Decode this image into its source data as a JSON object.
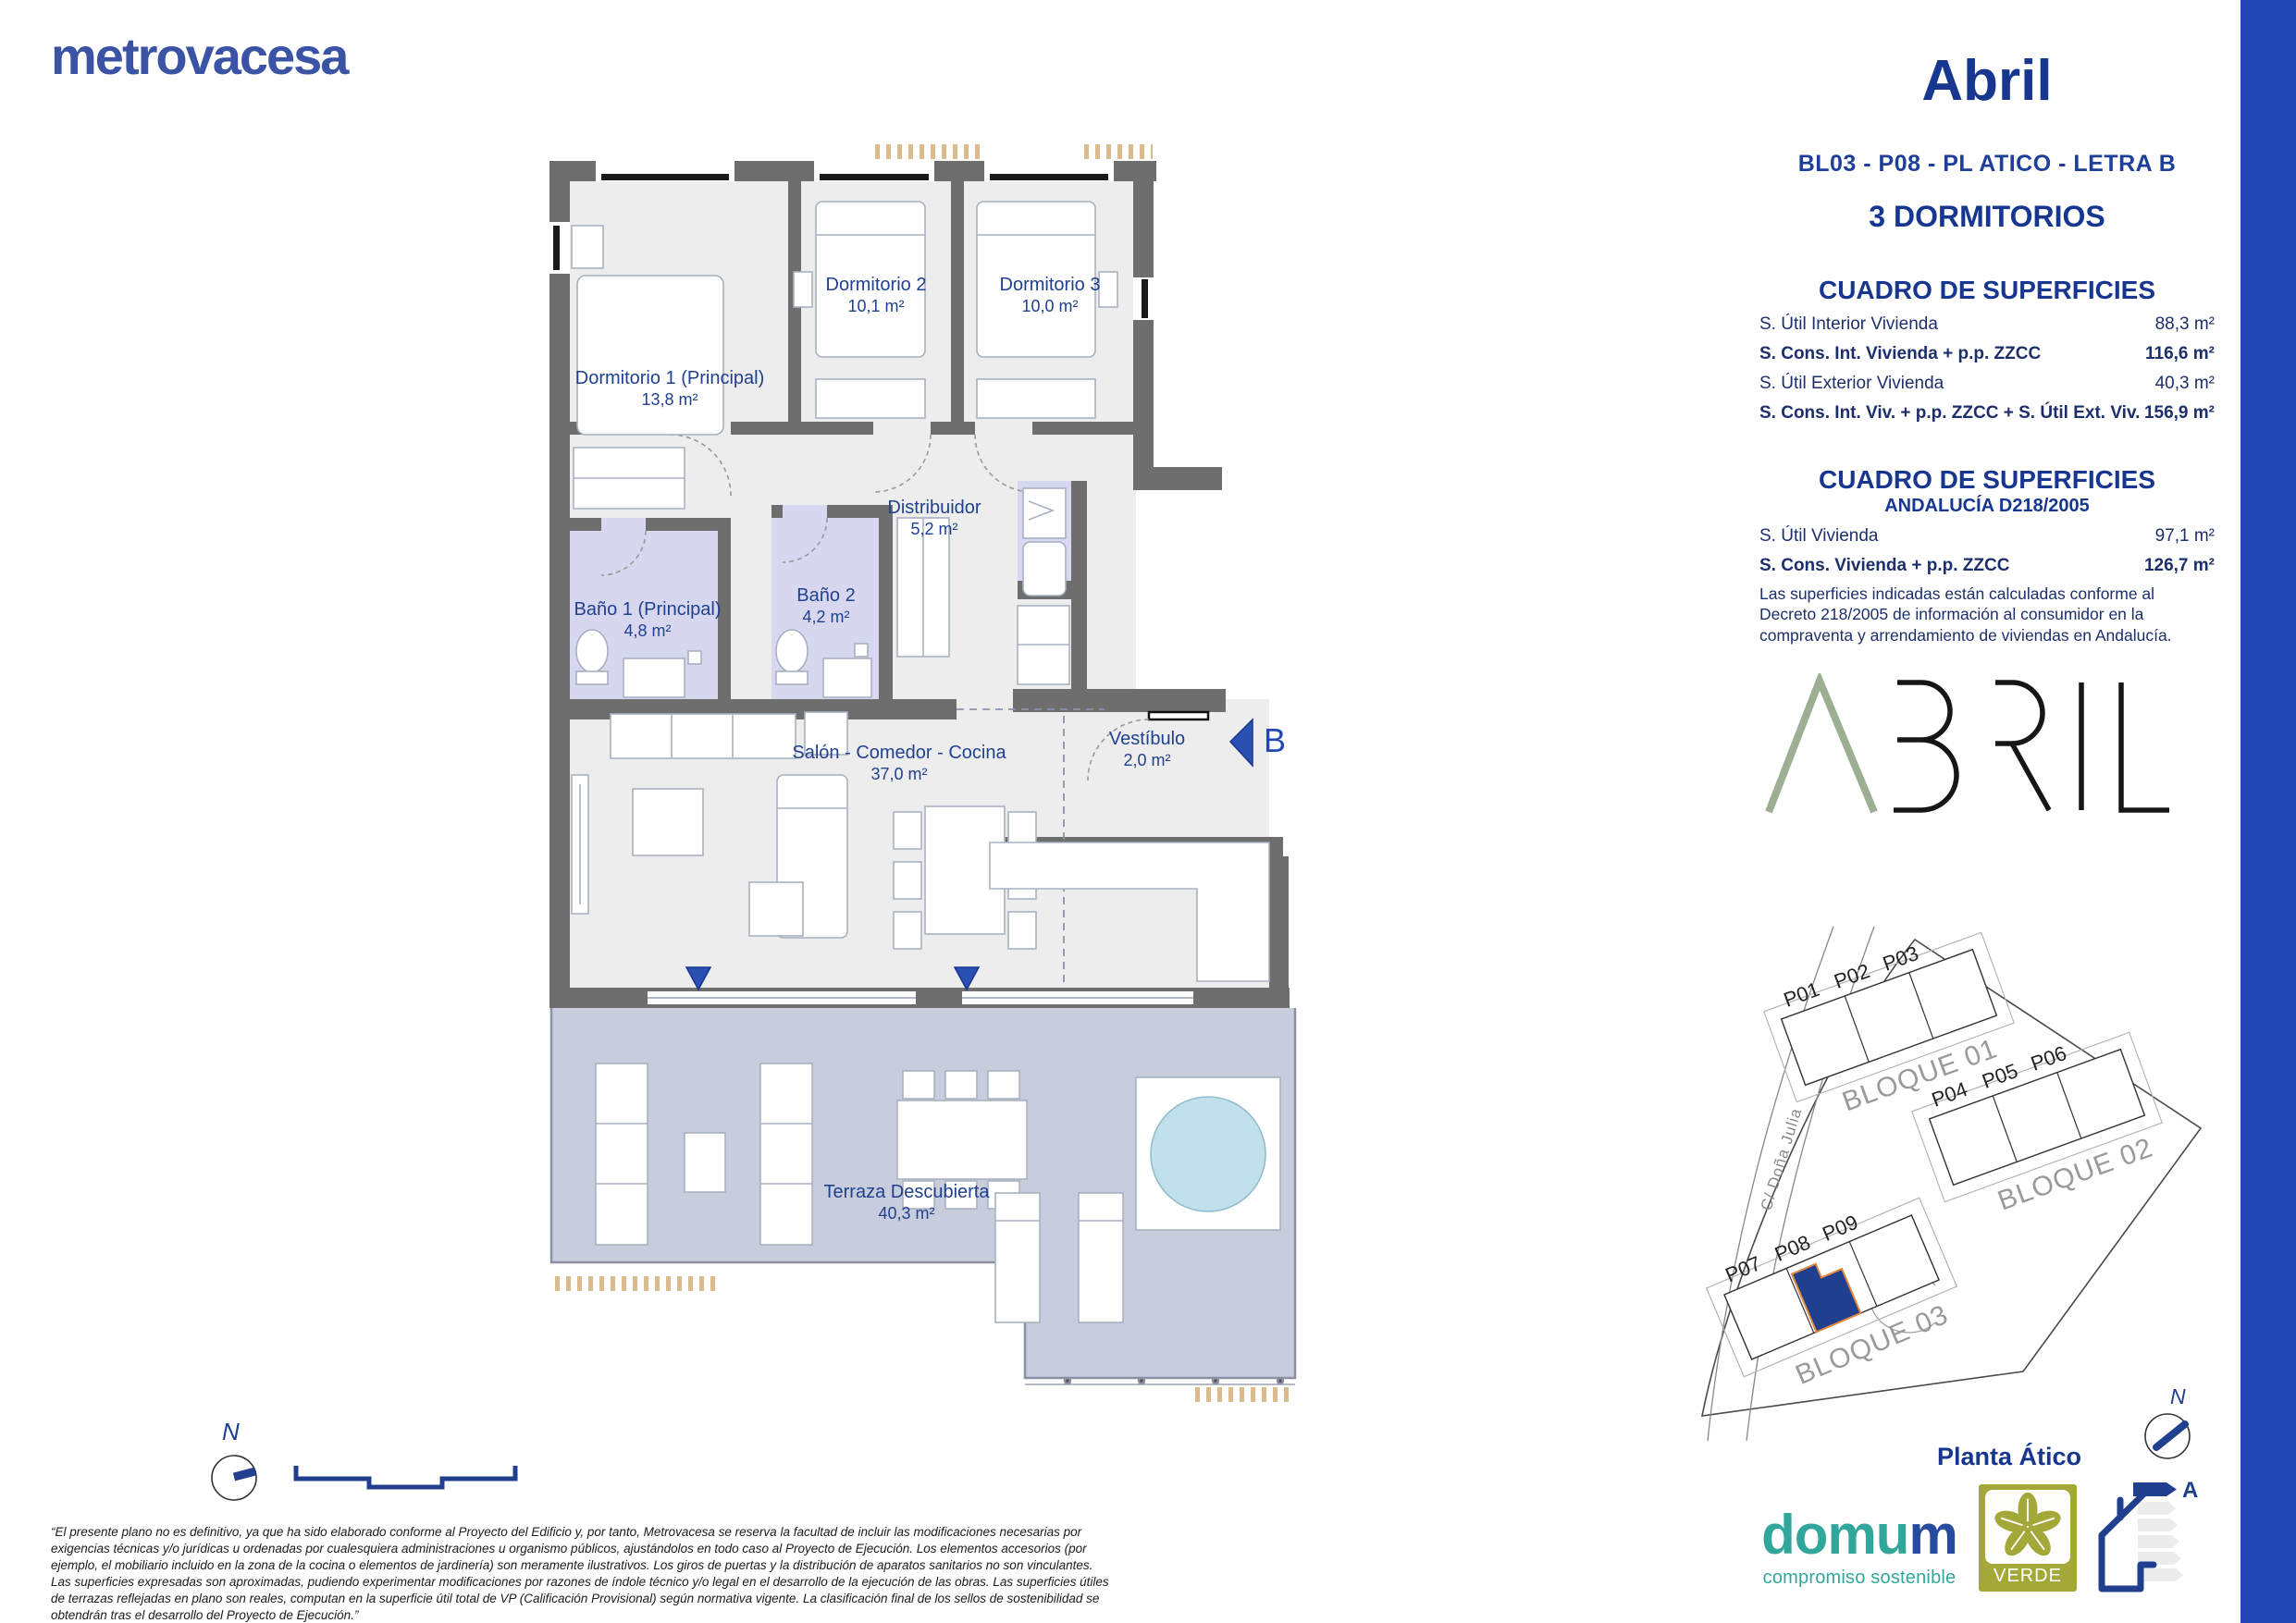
{
  "page": {
    "brand": "metrovacesa",
    "title": "Abril",
    "subtitle": "BL03 - P08 - PL ATICO - LETRA B",
    "bedrooms": "3 DORMITORIOS"
  },
  "tables": {
    "main": {
      "title": "CUADRO DE SUPERFICIES",
      "rows": [
        {
          "label": "S. Útil Interior Vivienda",
          "value": "88,3 m²"
        },
        {
          "label": "S. Cons. Int. Vivienda + p.p. ZZCC",
          "value": "116,6 m²"
        },
        {
          "label": "S. Útil Exterior Vivienda",
          "value": "40,3 m²"
        },
        {
          "label": "S. Cons. Int. Viv. + p.p. ZZCC + S. Útil Ext. Viv.",
          "value": "156,9 m²"
        }
      ]
    },
    "andalucia": {
      "title": "CUADRO DE SUPERFICIES",
      "subtitle": "ANDALUCÍA D218/2005",
      "rows": [
        {
          "label": "S. Útil Vivienda",
          "value": "97,1 m²"
        },
        {
          "label": "S. Cons. Vivienda + p.p. ZZCC",
          "value": "126,7 m²"
        }
      ],
      "note": "Las superficies indicadas están calculadas conforme al Decreto 218/2005 de información al consumidor en la compraventa y arrendamiento de viviendas en Andalucía."
    }
  },
  "plan": {
    "rooms": [
      {
        "name": "Dormitorio 1 (Principal)",
        "area": "13,8 m²"
      },
      {
        "name": "Dormitorio 2",
        "area": "10,1 m²"
      },
      {
        "name": "Dormitorio 3",
        "area": "10,0 m²"
      },
      {
        "name": "Distribuidor",
        "area": "5,2 m²"
      },
      {
        "name": "Baño 1 (Principal)",
        "area": "4,8 m²"
      },
      {
        "name": "Baño 2",
        "area": "4,2 m²"
      },
      {
        "name": "Salón - Comedor - Cocina",
        "area": "37,0 m²"
      },
      {
        "name": "Vestíbulo",
        "area": "2,0 m²"
      },
      {
        "name": "Terraza Descubierta",
        "area": "40,3 m²"
      }
    ],
    "entrance_letter": "B",
    "compass": "N"
  },
  "site": {
    "street": "C/ Doña Julia",
    "blocks": [
      {
        "name": "BLOQUE 01",
        "units": [
          "P01",
          "P02",
          "P03"
        ]
      },
      {
        "name": "BLOQUE 02",
        "units": [
          "P04",
          "P05",
          "P06"
        ]
      },
      {
        "name": "BLOQUE 03",
        "units": [
          "P07",
          "P08",
          "P09"
        ]
      }
    ],
    "highlighted_unit": "P08",
    "floor_label": "Planta Ático",
    "compass": "N"
  },
  "footer": {
    "disclaimer": "“El presente plano no es definitivo, ya que ha sido elaborado conforme al Proyecto del Edificio y, por tanto, Metrovacesa se reserva la facultad de incluir las modificaciones necesarias por exigencias técnicas y/o jurídicas u ordenadas por cualesquiera administraciones u organismo públicos, ajustándolos en todo caso al Proyecto de Ejecución. Los elementos accesorios (por ejemplo, el mobiliario incluido en la zona de la cocina o elementos de jardinería) son meramente ilustrativos. Los giros de puertas y la distribución de aparatos sanitarios no son vinculantes. Las superficies expresadas son aproximadas, pudiendo experimentar modificaciones por razones de índole técnico y/o legal en el desarrollo de la ejecución de las obras. Las superficies útiles de terrazas reflejadas en plano son reales, computan en la superficie útil total de VP (Calificación Provisional) según normativa vigente. La clasificación final de los sellos de sostenibilidad se obtendrán tras el desarrollo del Proyecto de Ejecución.”",
    "domum": {
      "prefix": "domu",
      "suffix": "m",
      "tagline": "compromiso sostenible"
    },
    "verde": "VERDE",
    "energy_rating": "A",
    "project_logo": "ABRIL"
  },
  "colors": {
    "brand_blue": "#3a53a4",
    "navy": "#16368f",
    "bar_blue": "#2247b4",
    "wall_gray": "#6e6e6e",
    "floor_gray": "#ededee",
    "bath_lavender": "#d7d8f0",
    "terrace_blue": "#c7cddd",
    "pool_blue": "#c0e1ec",
    "verde_olive": "#a3a838",
    "domum_teal": "#31a79b",
    "tan_hatch": "#d9bb8c",
    "abril_green": "#9cae93"
  }
}
